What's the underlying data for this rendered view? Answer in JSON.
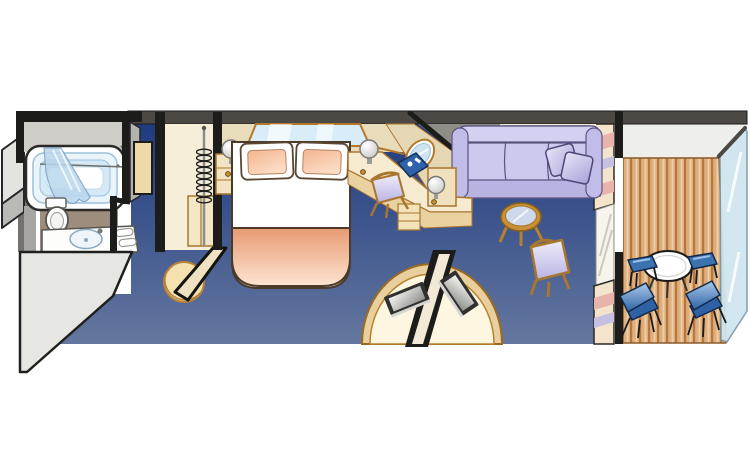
{
  "meta": {
    "type": "cruise-stateroom-floorplan",
    "description": "Isometric floor plan of a cruise ship suite: bathroom, entry, wardrobe, bedroom, vanity desk, media console, sitting area and private balcony",
    "width": 750,
    "height": 460
  },
  "rooms": {
    "bathroom": {
      "items": [
        "bathtub",
        "shower-curtain",
        "hand-shower",
        "curtain-rod",
        "toilet",
        "sink-vanity",
        "towels"
      ]
    },
    "entry": {
      "items": [
        "door-jamb",
        "corridor-carpet"
      ]
    },
    "wardrobe": {
      "items": [
        "hanging-rod",
        "hanger-coil",
        "cabinet",
        "sliding-door",
        "half-round-step"
      ]
    },
    "bedroom": {
      "items": [
        "queen-bed",
        "pillow-left",
        "pillow-right",
        "blanket",
        "nightstand",
        "table-lamp-left",
        "table-lamp-right",
        "headboard-window"
      ]
    },
    "vanity": {
      "items": [
        "angled-wall-mirror",
        "desk-counter",
        "desk-drawers",
        "desk-chair",
        "desk-lamp",
        "blue-folder"
      ]
    },
    "media": {
      "items": [
        "curved-tv-console",
        "divider-wall",
        "tv-bedroom-side",
        "tv-lounge-side"
      ]
    },
    "lounge": {
      "items": [
        "sofa",
        "sofa-pillow-1",
        "sofa-pillow-2",
        "glass-coffee-table",
        "armchair"
      ]
    },
    "balcony": {
      "items": [
        "curtain-top",
        "glass-door",
        "curtain-bottom",
        "door-frame",
        "deck-planks",
        "patio-table",
        "footstool-left",
        "footstool-right",
        "patio-chair-left",
        "patio-chair-right",
        "glass-railing"
      ]
    }
  },
  "colors": {
    "background": "#ffffff",
    "carpet_top": "#1e3a7e",
    "carpet_bottom": "#64779f",
    "wall_dark": "#4c4843",
    "wall_beige": "#e8dcba",
    "wall_gray": "#8f8d87",
    "cabinet_face": "#f6ead0",
    "cabinet_trim": "#a8762e",
    "blanket_dark": "#e89a72",
    "blanket_light": "#fde4d2",
    "pillow_peach": "#f3b590",
    "sofa": "#cac6ec",
    "sofa_shadow": "#b9b3e2",
    "chair_lavender": "#d8d4f2",
    "folder_blue": "#2e62aa",
    "deck_base": "#dfae7e",
    "deck_line": "#b5783d",
    "deck_highlight": "#edd0a8",
    "balcony_blue": "#3d72b0",
    "glass_blue": "#cfe5ef",
    "curtain_pink": "#e8b3aa",
    "curtain_cream": "#f4e4cc",
    "curtain_lavender": "#c5bfe2",
    "bath_floor": "#9c8d7d",
    "tub_blue": "#d4e8f5",
    "window_blue": "#d8edf8"
  }
}
